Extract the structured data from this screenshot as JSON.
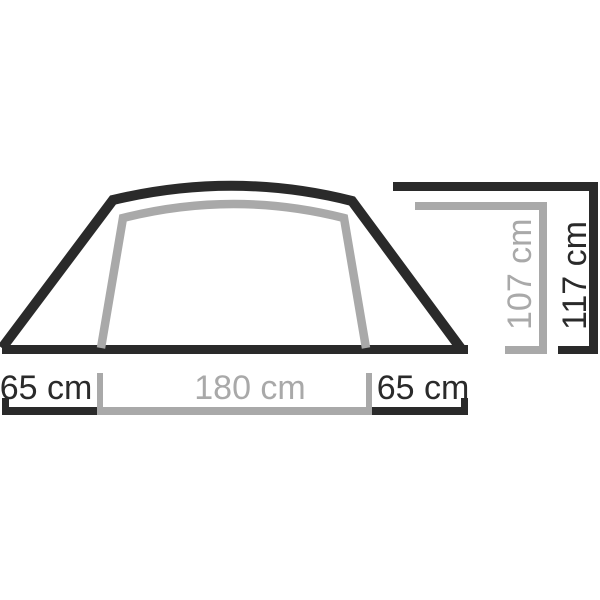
{
  "diagram": {
    "name": "tent-cross-section-dimensions",
    "labels": {
      "left_width": "65 cm",
      "inner_width": "180 cm",
      "right_width": "65 cm",
      "inner_height": "107 cm",
      "outer_height": "117 cm"
    },
    "colors": {
      "outer": "#2a2a2a",
      "inner": "#a9a9a9",
      "background": "#ffffff"
    }
  }
}
